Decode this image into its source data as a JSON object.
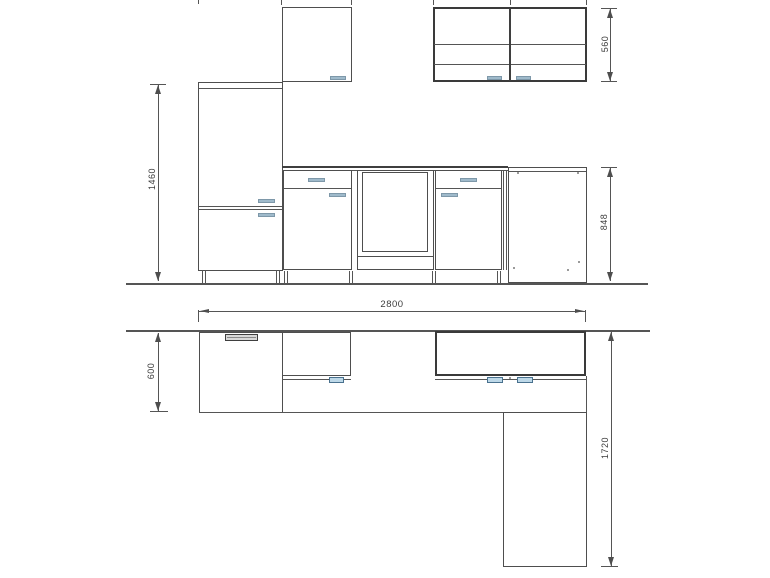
{
  "drawing": {
    "elevation": {
      "dim_tall_unit_height": "1460",
      "dim_wall_unit_height": "560",
      "dim_worktop_height": "848"
    },
    "plan": {
      "dim_total_width": "2800",
      "dim_counter_depth": "600",
      "dim_return_length": "1720"
    }
  }
}
